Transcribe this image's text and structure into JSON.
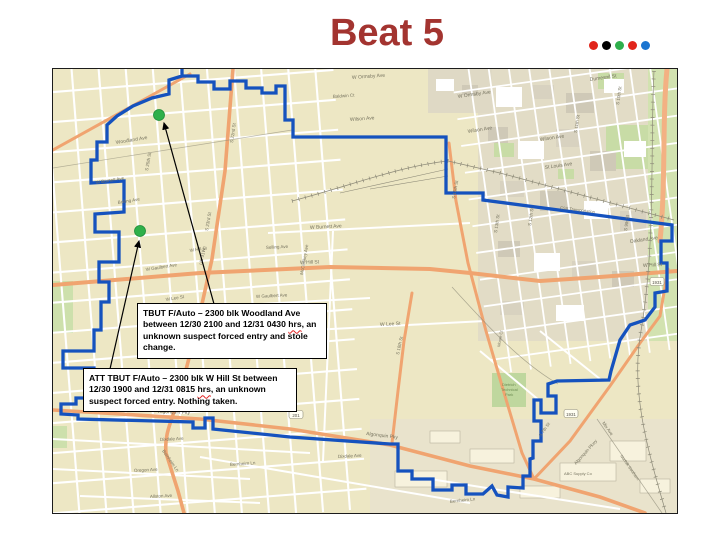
{
  "title": {
    "text": "Beat 5",
    "color": "#A33430"
  },
  "decor_dots": {
    "colors": [
      "#E1251B",
      "#000000",
      "#2FAF4C",
      "#E1251B",
      "#1B75D0"
    ]
  },
  "map": {
    "background": "#EDE7C4",
    "boundary_color": "#1552BE",
    "incident_dot_color": "#2FB04A",
    "incidents": [
      {
        "n": "incident-dot-woodland",
        "x": 159,
        "y": 114
      },
      {
        "n": "incident-dot-hill",
        "x": 140,
        "y": 230
      }
    ],
    "callouts": [
      {
        "pre": "TBUT F/Auto – 2300 blk Woodland Ave between 12/30 2100 and 12/31 0430 ",
        "wavy_word": "hrs",
        "post": ", an unknown suspect forced entry and stole change."
      },
      {
        "pre": "ATT TBUT F/Auto – 2300 blk W Hill St between 12/30 1900 and 12/31 0815 ",
        "wavy_word": "hrs",
        "post": ", an unknown suspect forced entry.  Nothing taken."
      }
    ],
    "route_shields": [
      {
        "t": "1931",
        "x": 657,
        "y": 281
      },
      {
        "t": "1931",
        "x": 571,
        "y": 413
      },
      {
        "t": "201",
        "x": 296,
        "y": 414
      }
    ],
    "street_labels": [
      {
        "t": "W Ormsby Ave",
        "x": 352,
        "y": 78,
        "r": -4
      },
      {
        "t": "W Ormsby Ave",
        "x": 458,
        "y": 97,
        "r": -8
      },
      {
        "t": "Baldwin Ct",
        "x": 333,
        "y": 97,
        "r": -4,
        "s": 4.5
      },
      {
        "t": "Wilson Ave",
        "x": 350,
        "y": 120,
        "r": -4
      },
      {
        "t": "Wilson Ave",
        "x": 468,
        "y": 132,
        "r": -9
      },
      {
        "t": "Wilson Ave",
        "x": 540,
        "y": 140,
        "r": -8
      },
      {
        "t": "Dumesnil St",
        "x": 590,
        "y": 80,
        "r": -8
      },
      {
        "t": "St Louis Ave",
        "x": 545,
        "y": 168,
        "r": -8
      },
      {
        "t": "Oakland Ave",
        "x": 630,
        "y": 242,
        "r": -8
      },
      {
        "t": "Woodland Ave",
        "x": 116,
        "y": 143,
        "r": -9
      },
      {
        "t": "S 25th St",
        "x": 148,
        "y": 170,
        "r": -80,
        "s": 4.5
      },
      {
        "t": "S 23rd St",
        "x": 208,
        "y": 230,
        "r": -80,
        "s": 4.5
      },
      {
        "t": "S 22nd St",
        "x": 233,
        "y": 142,
        "r": -82,
        "s": 4.5
      },
      {
        "t": "W Burnett Ave",
        "x": 96,
        "y": 183,
        "r": -9,
        "s": 4.5
      },
      {
        "t": "Bolling Ave",
        "x": 118,
        "y": 203,
        "r": -9,
        "s": 4.5
      },
      {
        "t": "W Burnett Ave",
        "x": 310,
        "y": 228,
        "r": -3
      },
      {
        "t": "Selling Ave",
        "x": 266,
        "y": 248,
        "r": -3,
        "s": 4.5
      },
      {
        "t": "W Hill St",
        "x": 300,
        "y": 263,
        "r": -2
      },
      {
        "t": "W Hill St",
        "x": 643,
        "y": 266,
        "r": -3
      },
      {
        "t": "W Hill St",
        "x": 190,
        "y": 251,
        "r": -9,
        "s": 4.5
      },
      {
        "t": "McCloskey Ave",
        "x": 303,
        "y": 274,
        "r": -80,
        "s": 4.5
      },
      {
        "t": "W Gaulbert Ave",
        "x": 256,
        "y": 297,
        "r": -3,
        "s": 4.5
      },
      {
        "t": "W Gaulbert Ave",
        "x": 146,
        "y": 270,
        "r": -9,
        "s": 4.5
      },
      {
        "t": "W Lee St",
        "x": 380,
        "y": 325,
        "r": -3
      },
      {
        "t": "W Lee St",
        "x": 166,
        "y": 300,
        "r": -9,
        "s": 4.5
      },
      {
        "t": "S 18th St",
        "x": 399,
        "y": 354,
        "r": -78,
        "s": 4.5
      },
      {
        "t": "S 15th St",
        "x": 455,
        "y": 198,
        "r": -80,
        "s": 4.5
      },
      {
        "t": "S 13th St",
        "x": 497,
        "y": 232,
        "r": -82,
        "s": 4.5
      },
      {
        "t": "S 12th St",
        "x": 531,
        "y": 225,
        "r": -82,
        "s": 4.5
      },
      {
        "t": "S 11th St",
        "x": 577,
        "y": 132,
        "r": -82,
        "s": 4.5
      },
      {
        "t": "S 10th St",
        "x": 619,
        "y": 104,
        "r": -82,
        "s": 4.5
      },
      {
        "t": "S 9th St",
        "x": 627,
        "y": 230,
        "r": -82,
        "s": 4.5
      },
      {
        "t": "S 7th St",
        "x": 541,
        "y": 436,
        "r": -55,
        "s": 4.5
      },
      {
        "t": "Algonquin Pky",
        "x": 158,
        "y": 412,
        "r": 2
      },
      {
        "t": "Algonquin Pky",
        "x": 366,
        "y": 434,
        "r": 7
      },
      {
        "t": "Algonquin Pkwy",
        "x": 576,
        "y": 464,
        "r": -48,
        "s": 4.5
      },
      {
        "t": "Dixdale Ave",
        "x": 160,
        "y": 440,
        "r": -3,
        "s": 4.5
      },
      {
        "t": "Dixdale Ave",
        "x": 338,
        "y": 457,
        "r": -3,
        "s": 4.5
      },
      {
        "t": "Oregon Ave",
        "x": 134,
        "y": 471,
        "r": -3,
        "s": 4.5
      },
      {
        "t": "Allston Ave",
        "x": 150,
        "y": 497,
        "r": -3,
        "s": 4.5
      },
      {
        "t": "Bernheim Ln",
        "x": 230,
        "y": 465,
        "r": -4,
        "s": 4.5
      },
      {
        "t": "Bernheim Ln",
        "x": 450,
        "y": 502,
        "r": -6,
        "s": 4.5
      },
      {
        "t": "Bernheim Ln",
        "x": 162,
        "y": 450,
        "r": 55,
        "s": 4.5
      },
      {
        "t": "US 31W",
        "x": 202,
        "y": 264,
        "r": -78,
        "s": 4.5
      },
      {
        "t": "Mix Ave",
        "x": 602,
        "y": 422,
        "r": 55,
        "s": 4.5
      },
      {
        "t": "Norfolk Southern",
        "x": 620,
        "y": 455,
        "r": 55,
        "s": 4
      },
      {
        "t": "ABC Supply Co",
        "x": 564,
        "y": 474,
        "s": 4
      },
      {
        "t": "CSX Transportation",
        "x": 560,
        "y": 208,
        "r": 7,
        "s": 4
      },
      {
        "t": "Dietrich",
        "x": 502,
        "y": 385,
        "s": 4,
        "c": "#6F8F55"
      },
      {
        "t": "Technical",
        "x": 501,
        "y": 390,
        "s": 4,
        "c": "#6F8F55"
      },
      {
        "t": "Park",
        "x": 505,
        "y": 395,
        "s": 4,
        "c": "#6F8F55"
      },
      {
        "t": "Moore Ct",
        "x": 500,
        "y": 346,
        "r": -80,
        "s": 4
      }
    ]
  }
}
